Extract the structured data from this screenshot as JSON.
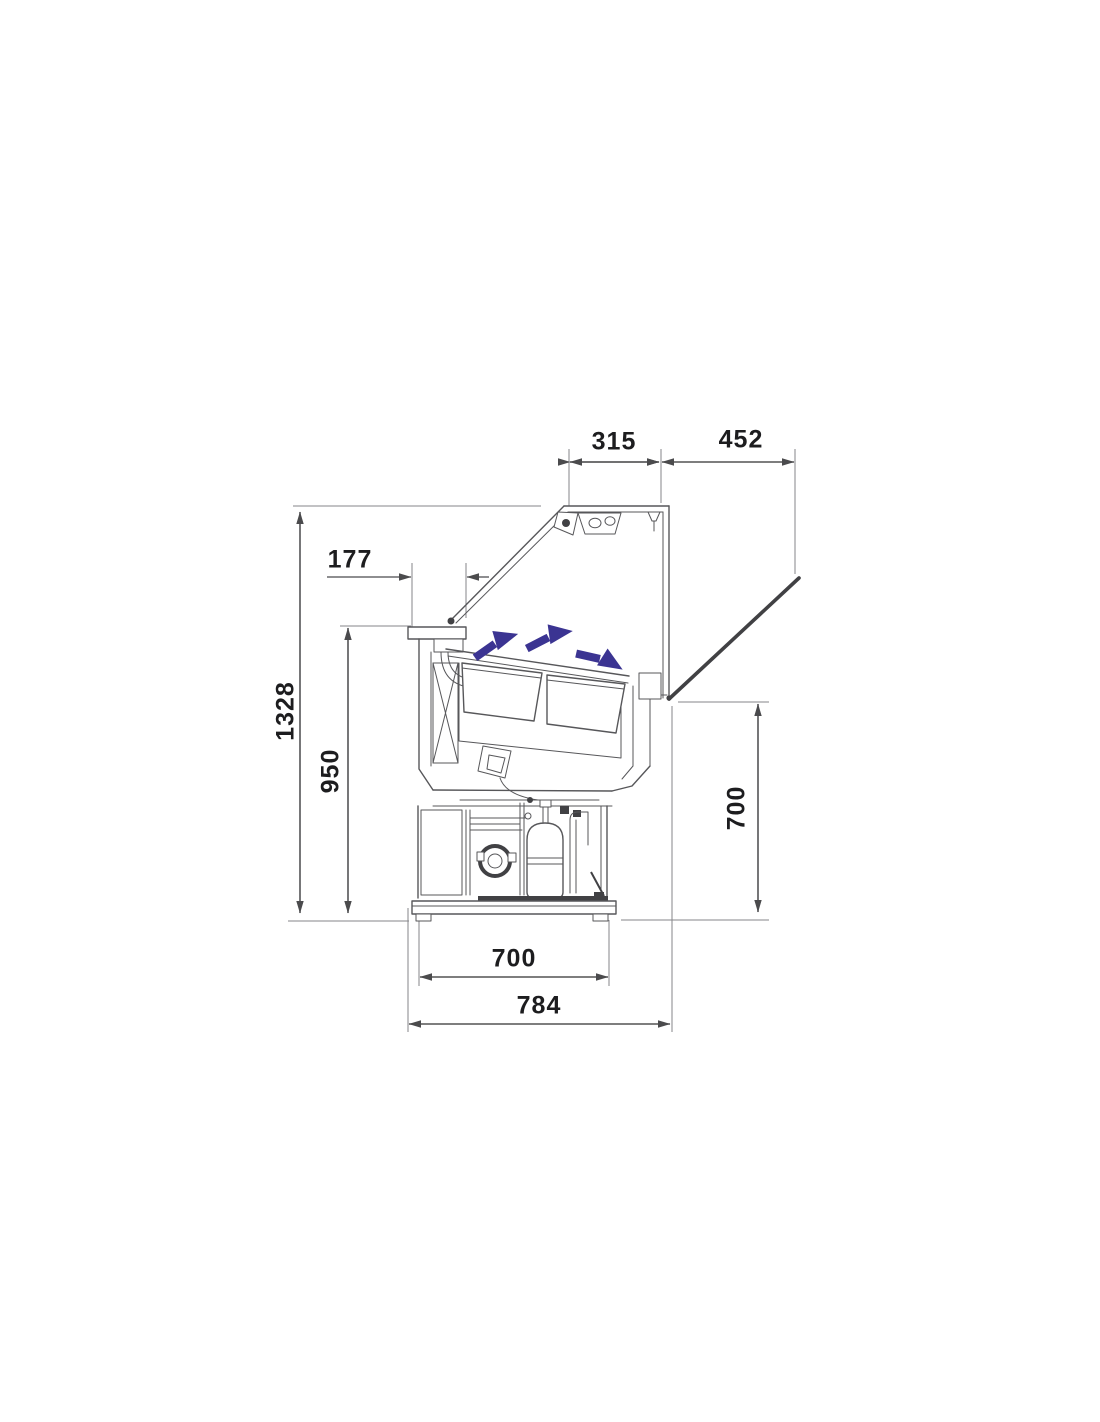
{
  "colors": {
    "background": "#ffffff",
    "line": "#57575a",
    "dark-line": "#414144",
    "dim": "#4b4b4d",
    "ext": "#85858a",
    "text": "#1d1d1f",
    "airflow": "#3b3492"
  },
  "diagram": {
    "type": "technical-dimension-drawing",
    "subject": "refrigerated display counter - side cross-section with open lid, airflow arrows and condensing unit",
    "units_implied": "mm",
    "dimensions": {
      "top_lid_width": "315",
      "open_glass_span": "452",
      "canopy_width": "177",
      "overall_height": "1328",
      "body_height": "950",
      "front_edge_height": "700",
      "base_width": "700",
      "overall_depth": "784"
    }
  }
}
